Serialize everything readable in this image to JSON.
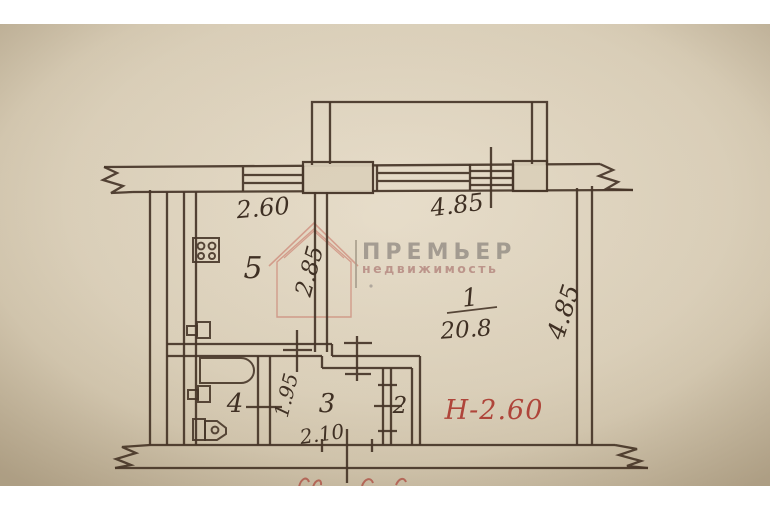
{
  "watermark": {
    "brand": "ПРЕМЬЕР",
    "tagline": "недвижимость",
    "logo": "house-icon"
  },
  "rooms": {
    "kitchen": "5",
    "living_number": "1",
    "living_area": "20.8",
    "bathroom": "4",
    "hallway": "3",
    "closet": "2"
  },
  "dims": {
    "kitchen_width": "2.60",
    "living_width": "4.85",
    "kitchen_depth": "2.85",
    "living_depth": "4.85",
    "hall_depth": "1.95",
    "hall_width": "2.10"
  },
  "notes": {
    "ceiling_height": "Н-2.60"
  },
  "colors": {
    "paper": "#ded3bd",
    "paper_edge": "#c7b99e",
    "ink": "#473629",
    "red_ink": "#b2453b",
    "watermark_gray": "#999289",
    "watermark_pink": "#b98f86",
    "watermark_logo_red": "#c0564a",
    "scan_margin": "#ffffff"
  }
}
